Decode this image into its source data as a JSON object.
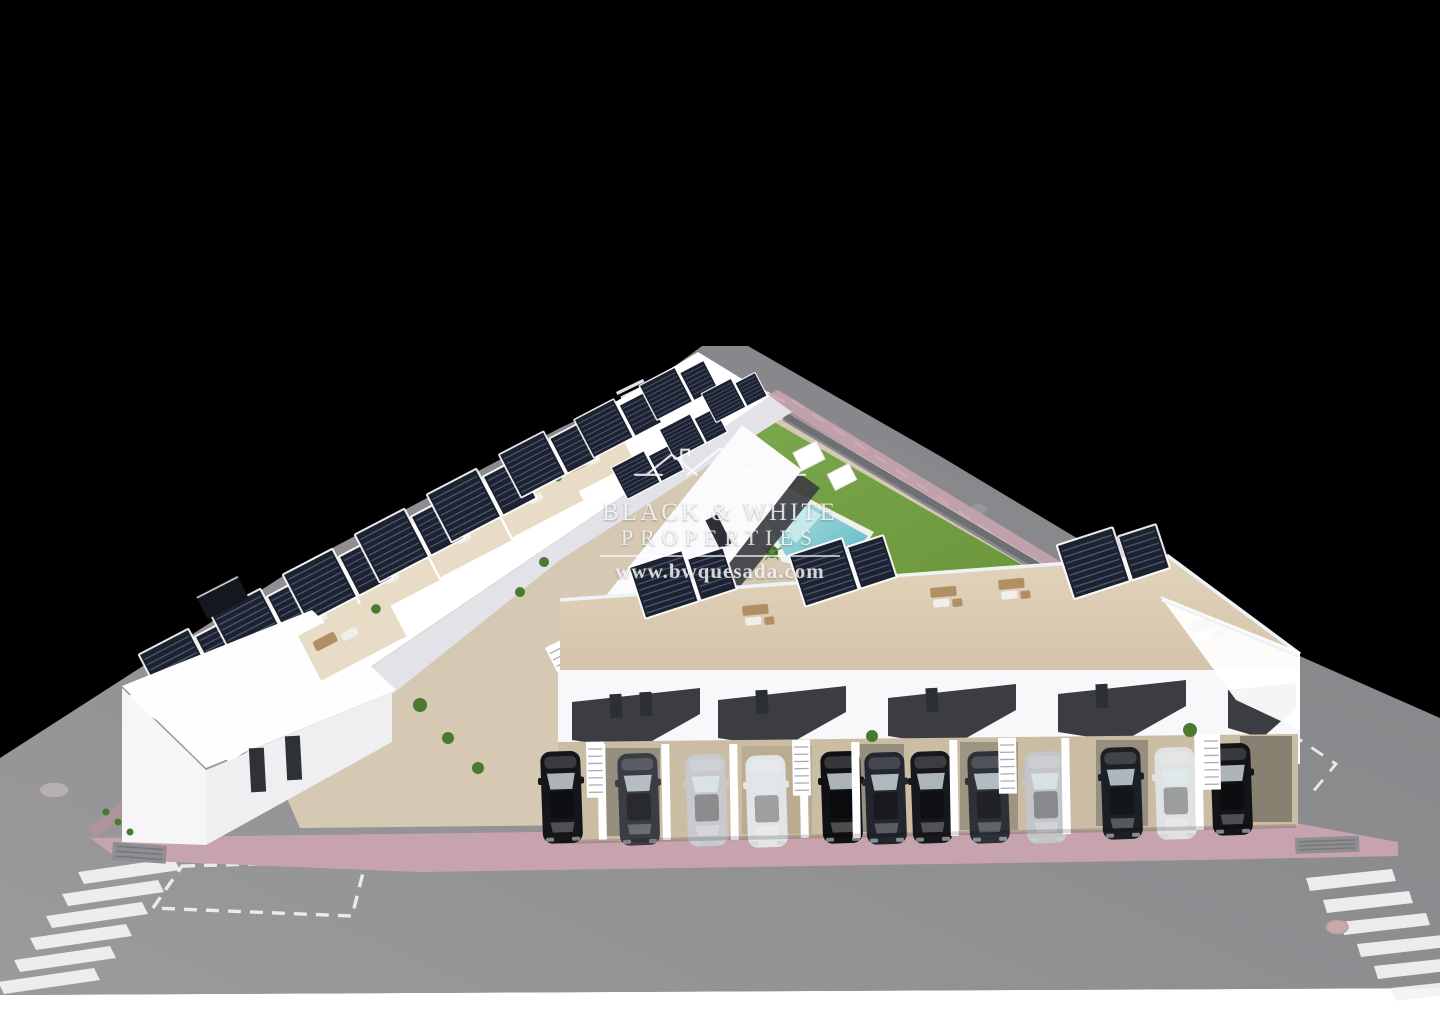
{
  "watermark": {
    "logo_icon": "roofline-houses-logo",
    "line1": "BLACK & WHITE",
    "line2": "PROPERTIES",
    "website": "www.bwquesada.com"
  },
  "scene_summary": {
    "type": "aerial-3d-architectural-render",
    "subject": "modern white townhouse development with roof terraces, solar pergolas, communal pool and street parking",
    "left_row_houses": 7,
    "front_row_houses": 7,
    "pools": 1,
    "crosswalks": 4,
    "manholes": 3
  },
  "cars": [
    {
      "color": "#15161a"
    },
    {
      "color": "#3a3d44"
    },
    {
      "color": "#c7c9cc"
    },
    {
      "color": "#e3e4e6"
    },
    {
      "color": "#101114"
    },
    {
      "color": "#23262e"
    },
    {
      "color": "#16181d"
    },
    {
      "color": "#2e3138"
    },
    {
      "color": "#c3c5c9"
    },
    {
      "color": "#1c2026"
    },
    {
      "color": "#e0e1e3"
    },
    {
      "color": "#131418"
    }
  ],
  "colors": {
    "background": "#000000",
    "asphalt": "#8d8d90",
    "asphalt-light": "#9c9c9e",
    "marking-white": "#f4f4f4",
    "sidewalk-pink": "#c7a3ae",
    "sidewalk-pink-deep": "#b9929f",
    "curb-grey": "#b9b9bb",
    "building-white": "#ffffff",
    "building-shade": "#e2e2e8",
    "facade-dark": "#3c3c43",
    "pergola-dark": "#1c2230",
    "pergola-slat": "#4a5470",
    "terrace-beige": "#e7dac4",
    "terrace-warm": "#d3c3aa",
    "courtyard-stone": "#d5c9b4",
    "driveway-tan": "#cbbda4",
    "lawn-green": "#69933e",
    "lawn-light": "#7aa74c",
    "pool-aqua": "#8fd3d8",
    "pool-deep": "#5fb8c4",
    "pool-shallow": "#cfeef0",
    "deck-white": "#f2f0ec",
    "wall-grey": "#6e6e73",
    "drain-grey": "#8f8f93",
    "furniture-wood": "#b28e63",
    "furniture-white": "#f1efe9",
    "plant-green": "#4a7a30",
    "palm-green": "#3f6b2a"
  }
}
